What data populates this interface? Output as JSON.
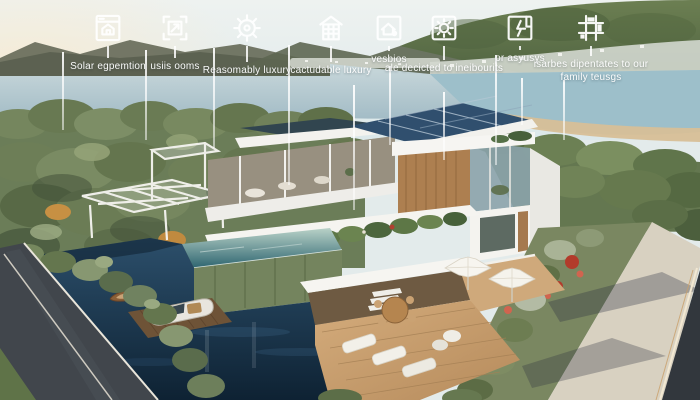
{
  "annotations": {
    "text_color": "#ffffff",
    "items": [
      {
        "icon": "blueprint-house-icon",
        "label": "Solar egpemtion"
      },
      {
        "icon": "window-frame-arrow-icon",
        "label": "usiis ooms"
      },
      {
        "icon": "wheel-gear-icon",
        "label": "Reasomably luxury"
      },
      {
        "icon": "apartment-building-icon",
        "label": "cactudable luxury"
      },
      {
        "icon": "house-dot-icon",
        "label": "vesbios"
      },
      {
        "icon": "sun-square-icon",
        "label": "ale decicted to ineibourits"
      },
      {
        "icon": "lightning-square-icon",
        "label": "or asyusys"
      },
      {
        "icon": "modular-blocks-icon",
        "label": "isarbes dipentates to our family teusgs"
      }
    ]
  },
  "palette": {
    "sky": "#e6eeee",
    "lake": "#b7cad1",
    "hills": "#5f7149",
    "trees": "#6b7d58",
    "house_white": "#f5f4f0",
    "wood": "#b5875a",
    "solar_panel": "#304f6e",
    "pool": "#377077",
    "canal_water": "#16293c",
    "road": "#41464c",
    "deck": "#c69e70",
    "annotation_line": "#ffffff"
  }
}
